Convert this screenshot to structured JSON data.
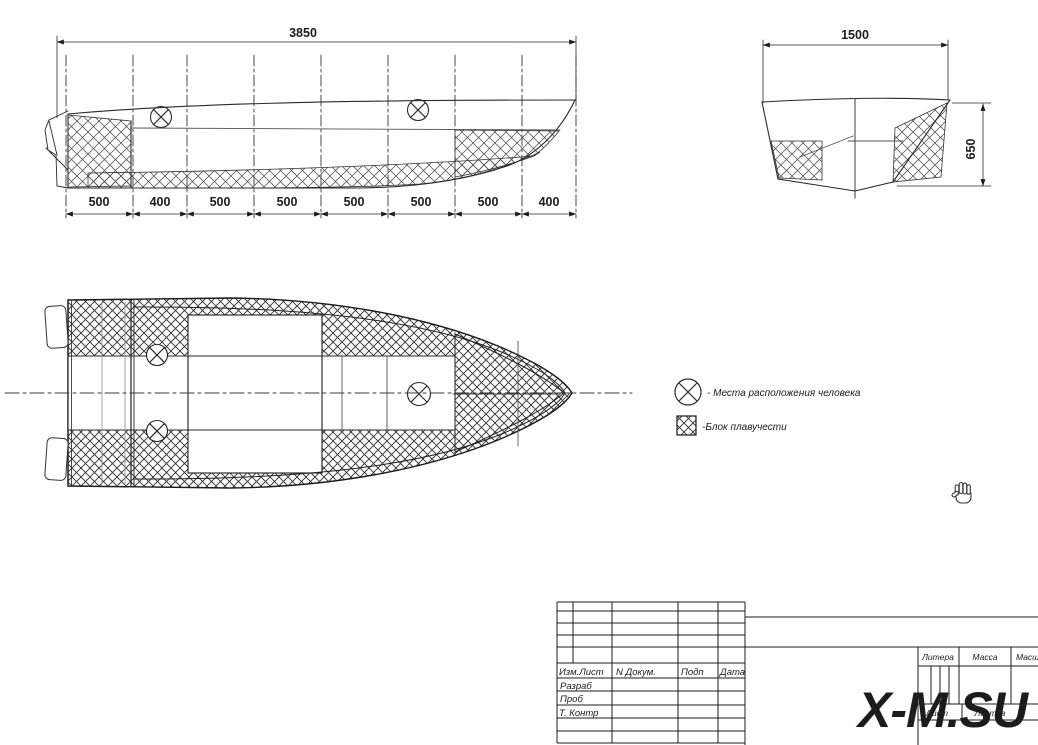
{
  "side_view": {
    "overall_dim": "3850",
    "segments": [
      "500",
      "400",
      "500",
      "500",
      "500",
      "500",
      "500",
      "400"
    ]
  },
  "section_view": {
    "width_dim": "1500",
    "height_dim": "650"
  },
  "legend": {
    "person_label": "- Места расположения человека",
    "buoyancy_label": "-Блок плавучести"
  },
  "title_block": {
    "izm_list": "Изм.Лист",
    "n_dokum": "N Докум.",
    "podp": "Подп",
    "data": "Дата",
    "razrab": "Разраб",
    "prov": "Проб",
    "t_kontr": "Т. Контр",
    "litera": "Литера",
    "massa": "Масса",
    "masshtab": "Масштаб",
    "list": "Лист",
    "listov": "Листов"
  },
  "watermark": "X-M.SU",
  "colors": {
    "line": "#2a2a2a",
    "secondary": "#999999",
    "watermark": "#0d0d0d"
  }
}
